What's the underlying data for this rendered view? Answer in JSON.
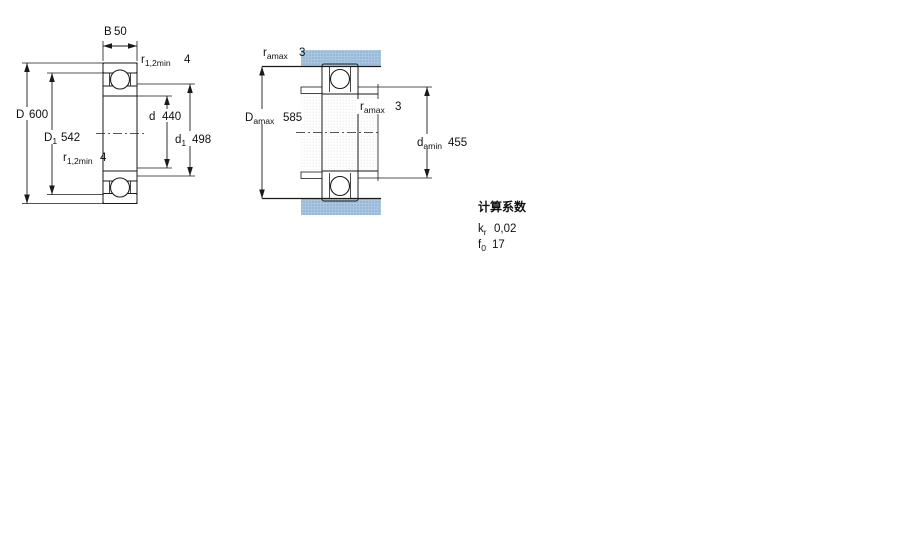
{
  "colors": {
    "line": "#1a1a1a",
    "ring_fill_blue": "#a9c7e1",
    "ring_dot_blue": "#7fa6c6",
    "faint_fill": "#ffffff",
    "faint_dot": "#e4e7ea"
  },
  "drawing": {
    "left_view": {
      "name": "bearing-cross-section",
      "dims": {
        "B": {
          "label": "B",
          "value": "50"
        },
        "D": {
          "label": "D",
          "value": "600"
        },
        "D1": {
          "label": "D",
          "sub": "1",
          "value": "542"
        },
        "d": {
          "label": "d",
          "value": "440"
        },
        "d1": {
          "label": "d",
          "sub": "1",
          "value": "498"
        },
        "r12a": {
          "label": "r",
          "sub": "1,2min",
          "value": "4"
        },
        "r12b": {
          "label": "r",
          "sub": "1,2min",
          "value": "4"
        }
      }
    },
    "right_view": {
      "name": "bearing-mounting-abutment",
      "dims": {
        "ra_top": {
          "label": "r",
          "sub": "amax",
          "value": "3"
        },
        "Damax": {
          "label": "D",
          "sub": "amax",
          "value": "585"
        },
        "ra_mid": {
          "label": "r",
          "sub": "amax",
          "value": "3"
        },
        "damin": {
          "label": "d",
          "sub": "amin",
          "value": "455"
        }
      }
    },
    "factors": {
      "title": "计算系数",
      "kr": {
        "label": "k",
        "sub": "r",
        "value": "0,02"
      },
      "f0": {
        "label": "f",
        "sub": "0",
        "value": "17"
      }
    }
  }
}
